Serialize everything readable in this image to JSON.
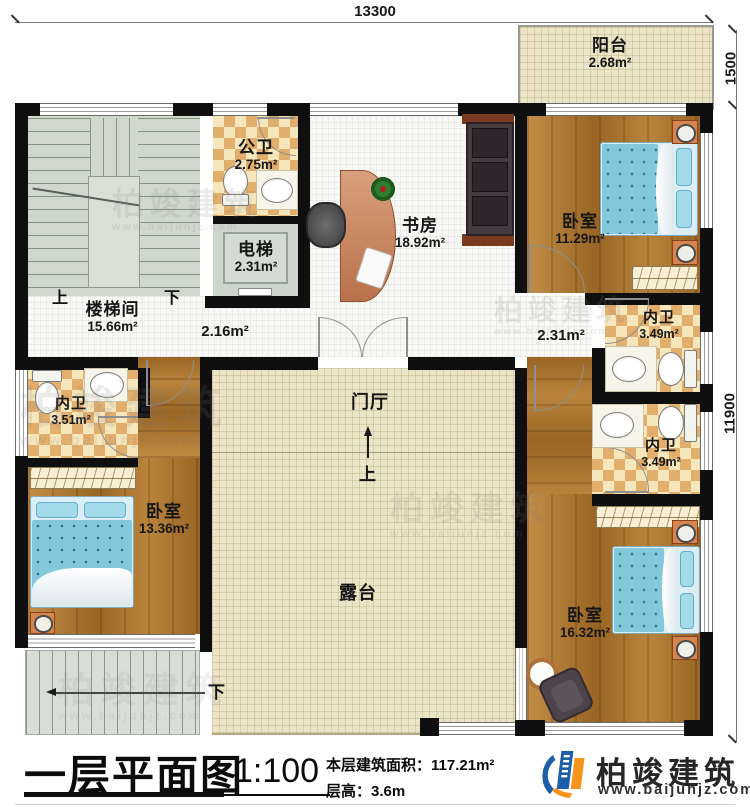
{
  "plan": {
    "dims": {
      "top": "13300",
      "right_top": "1500",
      "right_side": "11900"
    },
    "rooms": {
      "balcony": {
        "name": "阳台",
        "area": "2.68m²"
      },
      "public_bathture": {
        "name": "",
        "area": ""
      },
      "public_bath": {
        "name": "公卫",
        "area": "2.75m²"
      },
      "elevator": {
        "name": "电梯",
        "area": "2.31m²"
      },
      "study": {
        "name": "书房",
        "area": "18.92m²"
      },
      "bedroom_ne": {
        "name": "卧室",
        "area": "11.29m²"
      },
      "stairwell": {
        "name": "楼梯间",
        "area": "15.66m²"
      },
      "hall": {
        "area": "2.16m²"
      },
      "hall_e": {
        "area": "2.31m²"
      },
      "ensuite_e1": {
        "name": "内卫",
        "area": "3.49m²"
      },
      "ensuite_e2": {
        "name": "内卫",
        "area": "3.49m²"
      },
      "ensuite_w": {
        "name": "内卫",
        "area": "3.51m²"
      },
      "bedroom_w": {
        "name": "卧室",
        "area": "13.36m²"
      },
      "foyer": {
        "name": "门厅"
      },
      "terrace": {
        "name": "露台"
      },
      "bedroom_se": {
        "name": "卧室",
        "area": "16.32m²"
      }
    },
    "markers": {
      "up": "上",
      "down": "下"
    }
  },
  "title_block": {
    "title": "一层平面图",
    "scale": "1:100",
    "area_label": "本层建筑面积：",
    "area_value": "117.21m²",
    "floor_height_label": "层高：",
    "floor_height_value": "3.6m"
  },
  "brand": {
    "name": "柏竣建筑",
    "website": "www.baijunjz.com"
  },
  "watermark": {
    "name": "柏竣建筑",
    "website": "www.baijunjz.com"
  },
  "colors": {
    "wall": "#0f0f0f",
    "wood_floor": "#ad752c",
    "tile_beige": "#ece4c6",
    "bath_checker": "#e2ae6c",
    "bed_blue": "#84c8dc",
    "stair_floor": "#ced8cb",
    "logo_blue": "#1c5fa8",
    "logo_orange": "#f7941d"
  }
}
